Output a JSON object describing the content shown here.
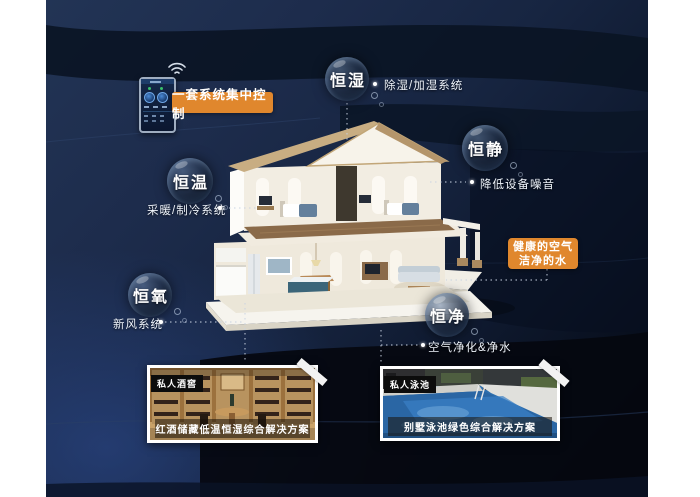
{
  "title": "智能家居五恒系统示意图",
  "controller": {
    "label": "一套系统集中控制",
    "wifi_icon": "wifi-signal"
  },
  "bubbles": [
    {
      "label": "恒湿",
      "note": "除湿/加湿系统"
    },
    {
      "label": "恒静",
      "note": "降低设备噪音"
    },
    {
      "label": "恒温",
      "note": "采暖/制冷系统"
    },
    {
      "label": "恒氧",
      "note": "新风系统"
    },
    {
      "label": "恒净",
      "note": "空气净化&净水"
    }
  ],
  "highlight_box": {
    "line1": "健康的空气",
    "line2": "洁净的水"
  },
  "cards": [
    {
      "tag": "私人酒窖",
      "caption": "红酒储藏低温恒湿综合解决方案"
    },
    {
      "tag": "私人泳池",
      "caption": "别墅泳池绿色综合解决方案"
    }
  ],
  "colors": {
    "accent_orange": "#e0872d",
    "background_navy": "#1b2a49",
    "deep_dark": "#05080f",
    "pool_blue": "#2e6fae",
    "roof_tan": "#c8ad82"
  }
}
